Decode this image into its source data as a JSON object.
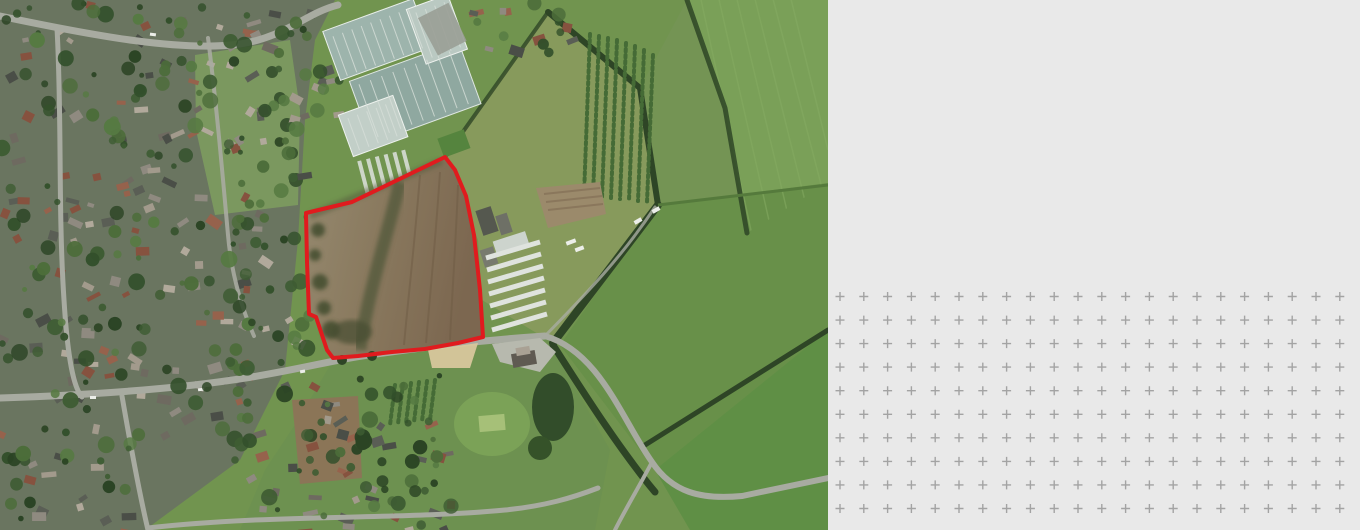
{
  "meta": {
    "description": "Aerial satellite site-location view (left) with a red site boundary drawn around a brown ploughed field on the edge of a village; blank light-grey panel with a plus-mark registration grid (right). No text visible in the screenshot.",
    "canvas": {
      "width": 1360,
      "height": 530
    }
  },
  "map": {
    "type": "satellite-aerial",
    "width_px": 828,
    "height_px": 530,
    "site_boundary": {
      "label": "site boundary outline",
      "points": "306,213 352,202 445,157 455,170 466,196 474,235 480,290 483,337 458,343 425,349 392,352 358,356 333,358 327,350 321,332 316,317 309,314 307,262",
      "stroke_width": 4
    },
    "colors": {
      "boundary_red": "#e01b1e",
      "urban_base": "#6a7560",
      "green_base": "#71944f",
      "green_light": "#7aa058",
      "green_mid": "#689049",
      "green_deep": "#4e7338",
      "olive_pasture": "#879a5c",
      "hedge_dark": "#2e4526",
      "road_gray": "#a8aba1",
      "parcel_light": "#95896f",
      "parcel_dark": "#7c6750",
      "glass_teal": "#9db4ac",
      "glass_light": "#bac9c2",
      "shed_white": "#dfe3de",
      "sand": "#d8c79c"
    },
    "features": [
      {
        "name": "residential-area",
        "desc": "dense village housing across west half"
      },
      {
        "name": "village-green",
        "desc": "open green space within village, upper left of centre"
      },
      {
        "name": "greenhouse-complex",
        "desc": "large glasshouse nursery, top centre"
      },
      {
        "name": "site-parcel",
        "desc": "brown ploughed field outlined in red, centre"
      },
      {
        "name": "farm-buildings",
        "desc": "farmyard with long white shed rows east of the site"
      },
      {
        "name": "orchard-rows",
        "desc": "tree rows north-east of the site"
      },
      {
        "name": "cricket-ground",
        "desc": "oval mown pitch south of the site"
      },
      {
        "name": "green-fields",
        "desc": "hedged pasture and arable fields, east half"
      },
      {
        "name": "roads",
        "desc": "village roads crossing the view"
      }
    ],
    "urban_texture": {
      "seed": 12,
      "house_palette": [
        "#4a4e47",
        "#5a5e55",
        "#8f8a80",
        "#a29a8c",
        "#96624c",
        "#86523f",
        "#b1a99b",
        "#6e6a60"
      ],
      "tree_palette": [
        "#33502b",
        "#3e5c33",
        "#2b4424",
        "#4c6d3a",
        "#567a42"
      ],
      "house_regions": [
        {
          "x": 0,
          "y": 0,
          "w": 135,
          "h": 530,
          "count": 72
        },
        {
          "x": 130,
          "y": 0,
          "w": 115,
          "h": 445,
          "count": 52
        },
        {
          "x": 242,
          "y": 0,
          "w": 100,
          "h": 118,
          "count": 20
        },
        {
          "x": 232,
          "y": 118,
          "w": 72,
          "h": 245,
          "count": 12
        },
        {
          "x": 235,
          "y": 365,
          "w": 215,
          "h": 165,
          "count": 42
        },
        {
          "x": 468,
          "y": 0,
          "w": 100,
          "h": 52,
          "count": 9
        }
      ],
      "tree_regions": [
        {
          "x": 0,
          "y": 0,
          "w": 140,
          "h": 530,
          "count": 85
        },
        {
          "x": 135,
          "y": 0,
          "w": 115,
          "h": 450,
          "count": 60
        },
        {
          "x": 245,
          "y": 0,
          "w": 100,
          "h": 120,
          "count": 16
        },
        {
          "x": 230,
          "y": 115,
          "w": 80,
          "h": 255,
          "count": 34
        },
        {
          "x": 230,
          "y": 360,
          "w": 220,
          "h": 170,
          "count": 40
        },
        {
          "x": 300,
          "y": 400,
          "w": 160,
          "h": 130,
          "count": 20
        },
        {
          "x": 460,
          "y": 0,
          "w": 110,
          "h": 55,
          "count": 8
        }
      ]
    }
  },
  "panel": {
    "background": "#e9e9e9",
    "plus_grid": {
      "color": "#a3a3a3",
      "cols": 22,
      "rows": 10,
      "spacing_x": 23.8,
      "spacing_y": 23.55,
      "start_x": 12,
      "start_y": 296.5,
      "arm_px": 4.5
    }
  }
}
